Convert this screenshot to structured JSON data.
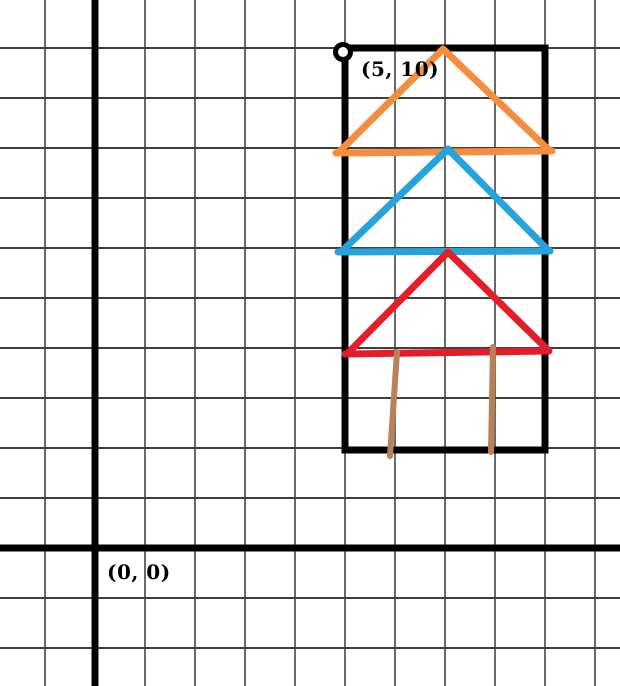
{
  "figure": {
    "width": 620,
    "height": 686,
    "background": "#ffffff",
    "grid": {
      "spacing": 50,
      "x_offset": 45,
      "y_offset": 48,
      "v_line_color": "#6a6a6a",
      "h_line_color": "#3f3f3f",
      "line_width": 2,
      "axis_color": "#000000",
      "axis_width": 7,
      "y_axis_x": 95,
      "x_axis_y": 548
    },
    "labels": [
      {
        "id": "origin-label",
        "text": "(0, 0)",
        "x": 107,
        "y": 560,
        "color": "#000000",
        "font_size": 20
      },
      {
        "id": "corner-point-label",
        "text": "(5, 10)",
        "x": 361,
        "y": 57,
        "color": "#000000",
        "font_size": 20
      }
    ],
    "graph_units": {
      "units_per_cell": 1,
      "origin": [
        0,
        0
      ],
      "marked_point": [
        5,
        10
      ],
      "frame_rectangle_corners": [
        [
          5,
          2
        ],
        [
          5,
          10
        ],
        [
          9,
          10
        ],
        [
          9,
          2
        ]
      ],
      "orange_triangle": [
        [
          5,
          8
        ],
        [
          7,
          10
        ],
        [
          9,
          8
        ]
      ],
      "blue_triangle": [
        [
          5,
          6
        ],
        [
          7,
          8
        ],
        [
          9,
          6
        ]
      ],
      "red_triangle": [
        [
          5,
          4
        ],
        [
          7,
          6
        ],
        [
          9,
          4
        ]
      ],
      "trunk_lines": [
        [
          [
            6,
            4
          ],
          [
            6,
            2
          ]
        ],
        [
          [
            8,
            4
          ],
          [
            8,
            2
          ]
        ]
      ]
    },
    "colors": {
      "frame": "#000000",
      "orange": "#F68C3E",
      "blue": "#25A3DC",
      "red": "#E31E2A",
      "brown": "#BA8056"
    },
    "shapes": [
      {
        "id": "house-frame-rect",
        "type": "rect",
        "x": 345,
        "y": 48,
        "w": 200,
        "h": 402,
        "stroke": "#000000",
        "width": 7
      },
      {
        "id": "corner-point-marker",
        "type": "circle",
        "cx": 343,
        "cy": 52,
        "r": 7.5,
        "stroke": "#000000",
        "width": 5,
        "fill": "#ffffff"
      },
      {
        "id": "orange-roof-sides",
        "type": "polyline",
        "points": [
          [
            339,
            152
          ],
          [
            443,
            49
          ],
          [
            550,
            151
          ]
        ],
        "stroke": "#F68C3E",
        "width": 7
      },
      {
        "id": "orange-roof-base",
        "type": "polyline",
        "points": [
          [
            336,
            153
          ],
          [
            552,
            151
          ]
        ],
        "stroke": "#F68C3E",
        "width": 7
      },
      {
        "id": "blue-tree-sides",
        "type": "polyline",
        "points": [
          [
            342,
            251
          ],
          [
            448,
            149
          ],
          [
            548,
            250
          ]
        ],
        "stroke": "#25A3DC",
        "width": 7
      },
      {
        "id": "blue-tree-base",
        "type": "polyline",
        "points": [
          [
            338,
            252
          ],
          [
            550,
            251
          ]
        ],
        "stroke": "#25A3DC",
        "width": 7
      },
      {
        "id": "red-tree-sides",
        "type": "polyline",
        "points": [
          [
            348,
            353
          ],
          [
            448,
            252
          ],
          [
            548,
            350
          ]
        ],
        "stroke": "#E31E2A",
        "width": 7
      },
      {
        "id": "red-tree-base",
        "type": "polyline",
        "points": [
          [
            345,
            354
          ],
          [
            549,
            351
          ]
        ],
        "stroke": "#E31E2A",
        "width": 7
      },
      {
        "id": "trunk-left-line",
        "type": "polyline",
        "points": [
          [
            397,
            352
          ],
          [
            390,
            456
          ]
        ],
        "stroke": "#BA8056",
        "width": 6
      },
      {
        "id": "trunk-right-line",
        "type": "polyline",
        "points": [
          [
            493,
            347
          ],
          [
            491,
            452
          ]
        ],
        "stroke": "#BA8056",
        "width": 6
      }
    ]
  }
}
